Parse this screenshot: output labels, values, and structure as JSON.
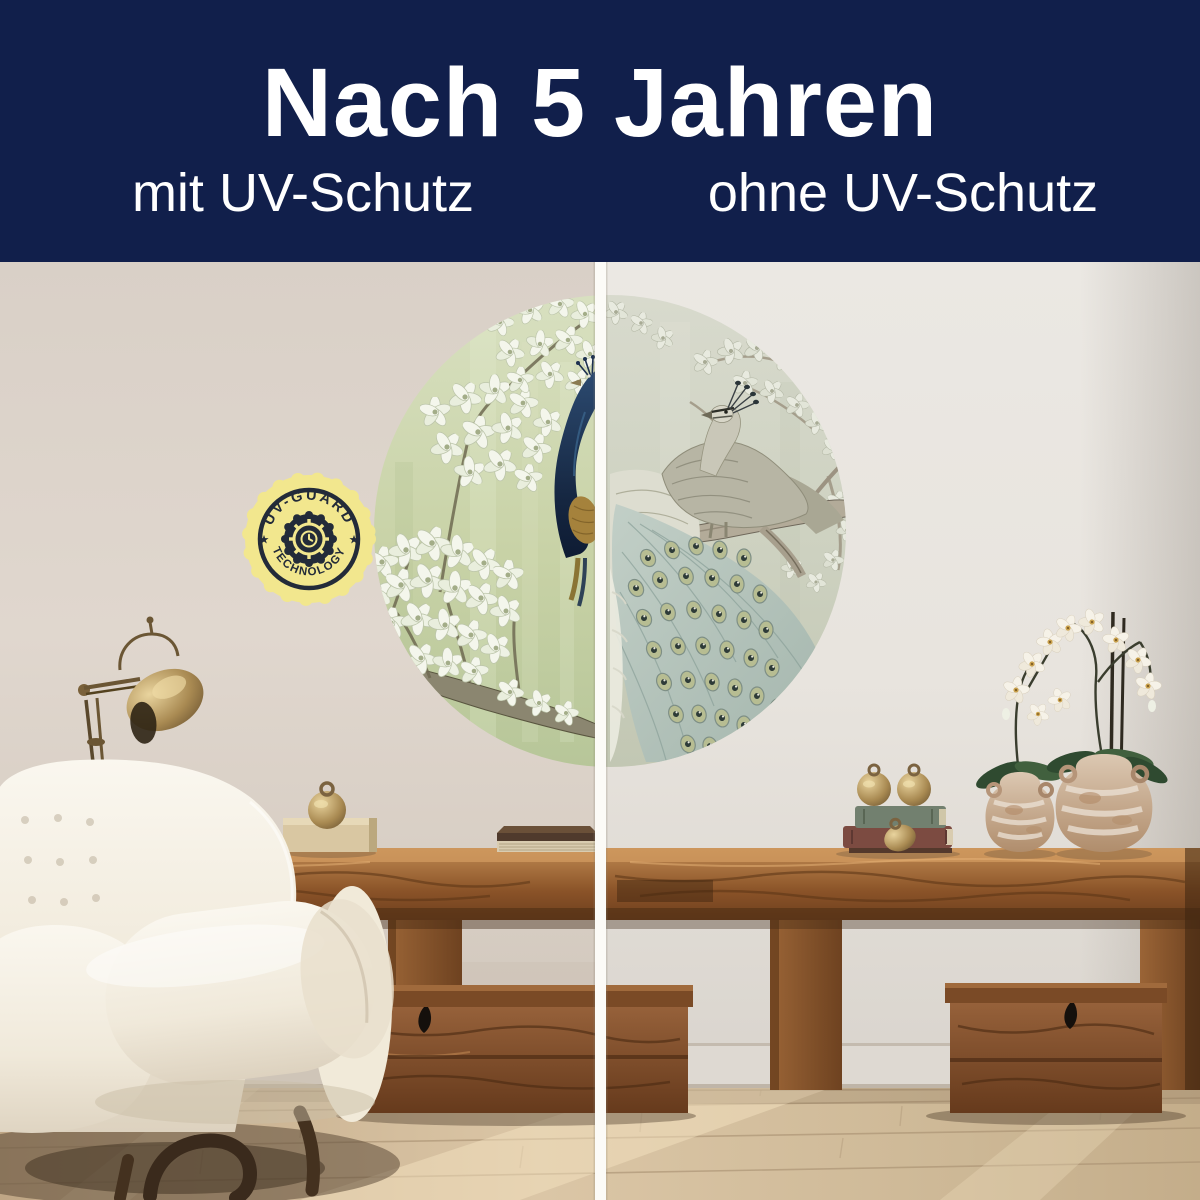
{
  "header": {
    "title": "Nach 5 Jahren",
    "left_label": "mit UV-Schutz",
    "right_label": "ohne UV-Schutz",
    "background": "#111f4b",
    "text_color": "#ffffff"
  },
  "badge": {
    "top_text": "UV-GUARD",
    "bottom_text": "TECHNOLOGY",
    "star": "★",
    "fill": "#f2e78e",
    "ink": "#232b39"
  },
  "comparison": {
    "divider_color": "#fcfbf7",
    "left_mural_tone": "#c8d2a6",
    "right_mural_tone": "#cdd1c0"
  },
  "palette": {
    "wall_left": "#dcd3ca",
    "wall_right": "#e9e6e1",
    "wood": "#8a5328",
    "floor": "#d3bfa1",
    "chair_boucle": "#f4efe3",
    "brass": "#a98a52",
    "peacock_navy": "#16273f",
    "tail_teal": "#a9bcb2"
  }
}
